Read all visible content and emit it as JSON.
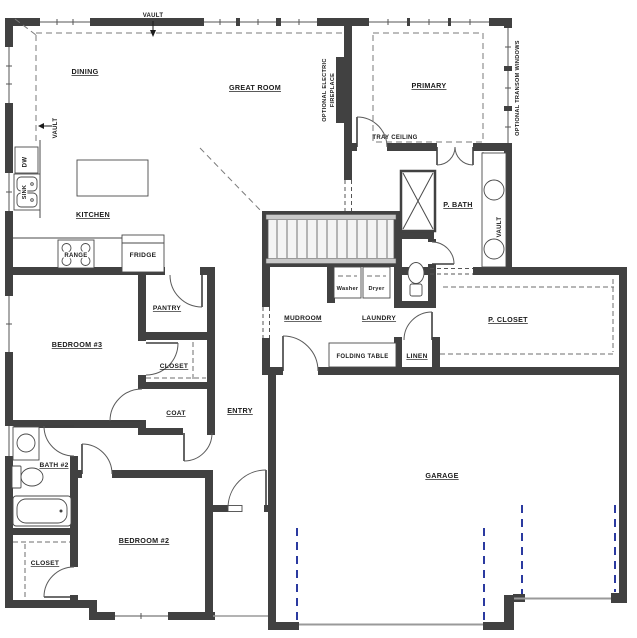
{
  "plan": {
    "type": "residential-floor-plan",
    "rooms": {
      "dining": "DINING",
      "great_room": "GREAT ROOM",
      "primary": "PRIMARY",
      "kitchen": "KITCHEN",
      "pantry": "PANTRY",
      "bedroom3": "BEDROOM #3",
      "closet_bed3": "CLOSET",
      "coat": "COAT",
      "entry": "ENTRY",
      "mudroom": "MUDROOM",
      "laundry": "LAUNDRY",
      "linen": "LINEN",
      "p_closet": "P. CLOSET",
      "p_bath": "P. BATH",
      "bath2": "BATH #2",
      "bedroom2": "BEDROOM #2",
      "closet_bed2": "CLOSET",
      "garage": "GARAGE"
    },
    "fixtures": {
      "washer": "Washer",
      "dryer": "Dryer",
      "folding_table": "FOLDING TABLE",
      "range": "RANGE",
      "fridge": "FRIDGE",
      "sink": "SINK",
      "dishwasher": "DW"
    },
    "annotations": {
      "vault_top": "VAULT",
      "vault_left": "VAULT",
      "vault_bath": "VAULT",
      "tray_ceiling": "TRAY CEILING",
      "optional_electric_fireplace_line1": "OPTIONAL ELECTRIC",
      "optional_electric_fireplace_line2": "FIREPLACE",
      "optional_transom_windows": "OPTIONAL TRANSOM WINDOWS"
    },
    "colors": {
      "wall": "#414141",
      "ceiling_dash": "#7a7a7a",
      "garage_track_blue": "#2b3aa0",
      "garage_door_gray": "#9a9a9a",
      "background": "#ffffff",
      "text": "#1b1b1b"
    }
  }
}
